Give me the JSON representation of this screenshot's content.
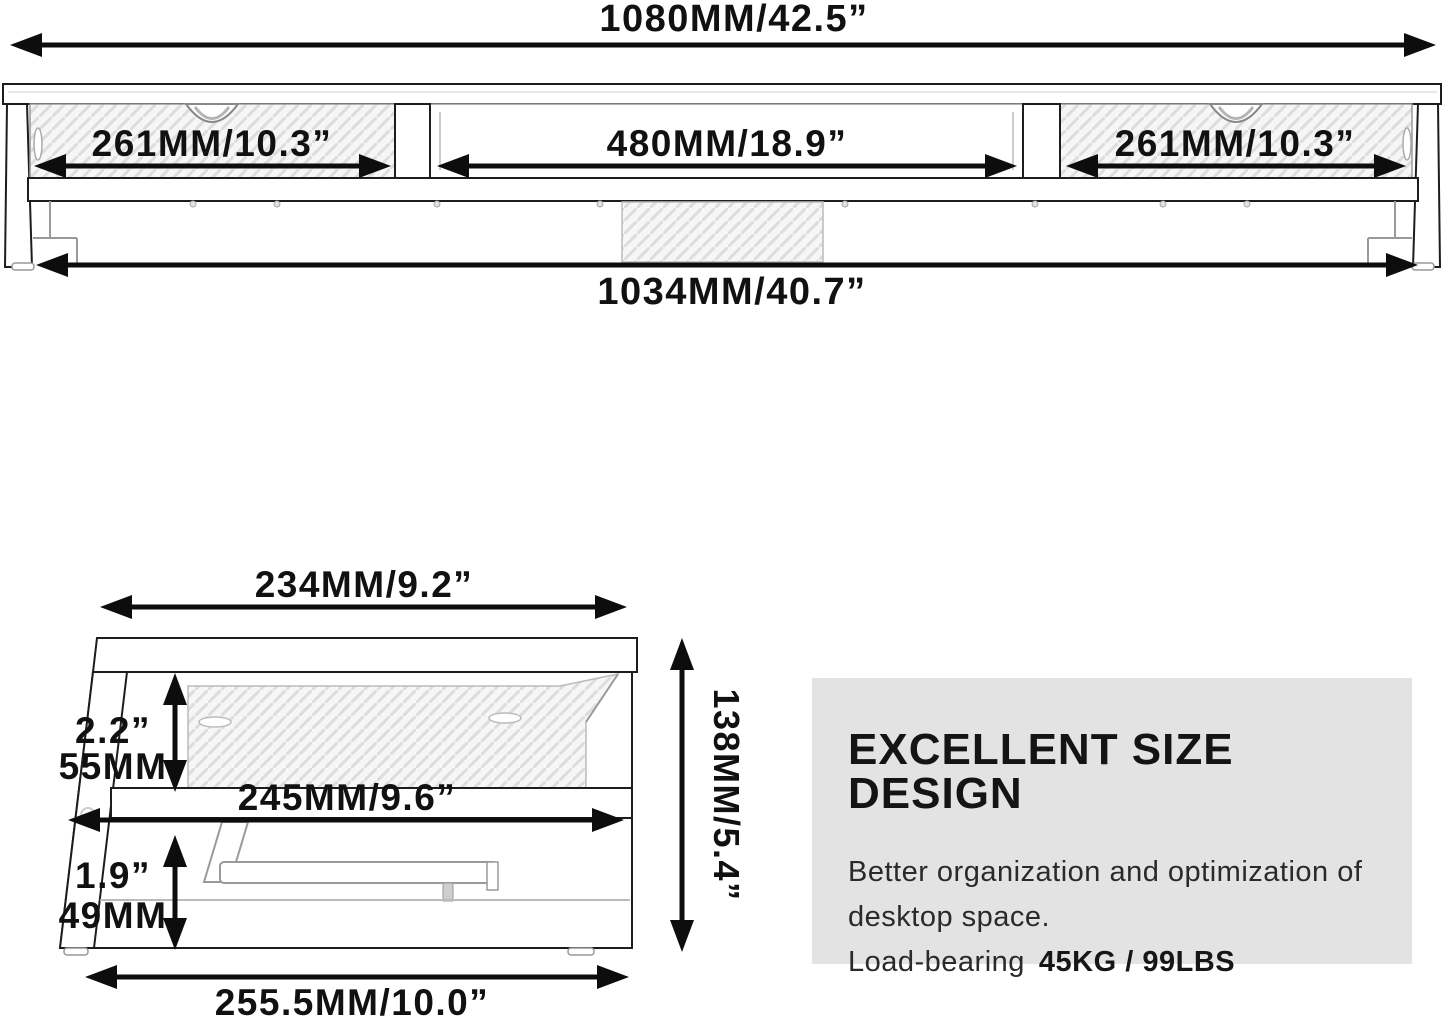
{
  "front_view": {
    "overall_width": "1080MM/42.5”",
    "left_section": "261MM/10.3”",
    "middle_section": "480MM/18.9”",
    "right_section": "261MM/10.3”",
    "base_width": "1034MM/40.7”"
  },
  "side_view": {
    "top_depth": "234MM/9.2”",
    "upper_clearance_in": "2.2”",
    "upper_clearance_mm": "55MM",
    "shelf_depth": "245MM/9.6”",
    "lower_clearance_in": "1.9”",
    "lower_clearance_mm": "49MM",
    "overall_height": "138MM/5.4”",
    "base_depth": "255.5MM/10.0”"
  },
  "info_box": {
    "title": "EXCELLENT SIZE DESIGN",
    "line1": "Better organization and optimization of",
    "line2": "desktop space.",
    "load_label": "Load-bearing",
    "load_value": "45KG / 99LBS",
    "background": "#e3e3e3",
    "text_color": "#111111"
  }
}
